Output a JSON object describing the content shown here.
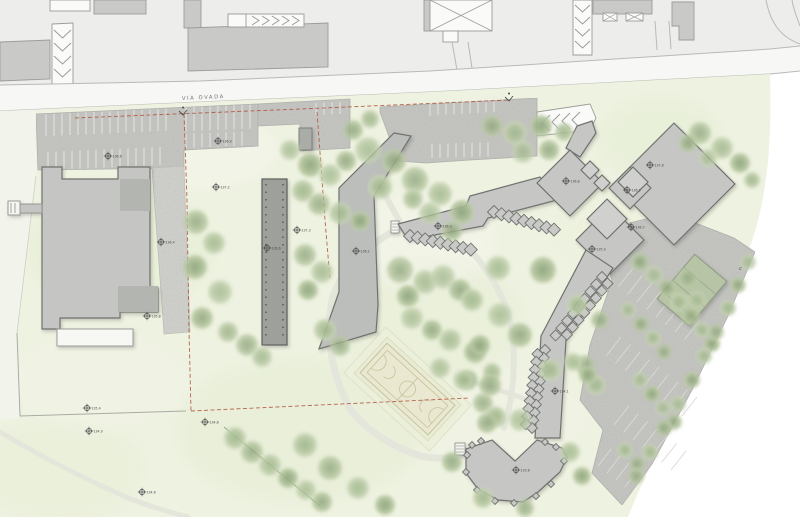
{
  "road": {
    "name": "VIA  OVADA",
    "curve_mark": "c"
  },
  "colors": {
    "field_green": "#eef2e0",
    "asphalt": "#c9c9c6",
    "building_gray": "#c6c7c5",
    "building_dark": "#9ea09c",
    "boundary_red": "#b2543e",
    "tree_green": "#a9bc98",
    "court_tan": "#eae8d0",
    "road_line": "#b9b9b6"
  },
  "symbols": {
    "benchmark": "circle-cross-elevation-marker",
    "entrance": "v-arrow-with-dot",
    "entrance_positions": [
      [
        183,
        112
      ],
      [
        509,
        98
      ]
    ],
    "curve_mark_position": [
      740,
      268
    ]
  },
  "elevation_markers": [
    {
      "x": 108,
      "y": 156,
      "v": "136.6"
    },
    {
      "x": 218,
      "y": 141,
      "v": "136.9"
    },
    {
      "x": 216,
      "y": 187,
      "v": "137.2"
    },
    {
      "x": 161,
      "y": 242,
      "v": "136.4"
    },
    {
      "x": 147,
      "y": 316,
      "v": "135.8"
    },
    {
      "x": 297,
      "y": 230,
      "v": "137.3"
    },
    {
      "x": 267,
      "y": 248,
      "v": "136.6"
    },
    {
      "x": 356,
      "y": 251,
      "v": "136.2"
    },
    {
      "x": 438,
      "y": 226,
      "v": "136.3"
    },
    {
      "x": 566,
      "y": 181,
      "v": "136.8"
    },
    {
      "x": 650,
      "y": 165,
      "v": "137.8"
    },
    {
      "x": 627,
      "y": 190,
      "v": "136.9"
    },
    {
      "x": 631,
      "y": 227,
      "v": "136.7"
    },
    {
      "x": 592,
      "y": 249,
      "v": "135.9"
    },
    {
      "x": 555,
      "y": 391,
      "v": "134.1"
    },
    {
      "x": 516,
      "y": 470,
      "v": "133.8"
    },
    {
      "x": 87,
      "y": 408,
      "v": "135.4"
    },
    {
      "x": 89,
      "y": 431,
      "v": "134.9"
    },
    {
      "x": 205,
      "y": 422,
      "v": "134.8"
    },
    {
      "x": 142,
      "y": 492,
      "v": "134.6"
    }
  ],
  "trees": [
    [
      368,
      150,
      13
    ],
    [
      394,
      161,
      12
    ],
    [
      380,
      187,
      12
    ],
    [
      415,
      180,
      13
    ],
    [
      440,
      194,
      12
    ],
    [
      462,
      212,
      12
    ],
    [
      430,
      213,
      11
    ],
    [
      452,
      231,
      10
    ],
    [
      413,
      199,
      10
    ],
    [
      492,
      126,
      11
    ],
    [
      515,
      133,
      12
    ],
    [
      541,
      126,
      11
    ],
    [
      523,
      152,
      11
    ],
    [
      549,
      150,
      10
    ],
    [
      564,
      132,
      9
    ],
    [
      700,
      133,
      11
    ],
    [
      722,
      148,
      11
    ],
    [
      740,
      163,
      10
    ],
    [
      708,
      158,
      9
    ],
    [
      688,
      143,
      9
    ],
    [
      752,
      180,
      8
    ],
    [
      196,
      222,
      12
    ],
    [
      214,
      243,
      11
    ],
    [
      195,
      267,
      12
    ],
    [
      220,
      292,
      12
    ],
    [
      202,
      318,
      11
    ],
    [
      228,
      332,
      10
    ],
    [
      247,
      345,
      11
    ],
    [
      262,
      357,
      10
    ],
    [
      310,
      165,
      12
    ],
    [
      330,
      175,
      11
    ],
    [
      346,
      161,
      10
    ],
    [
      303,
      191,
      11
    ],
    [
      319,
      204,
      11
    ],
    [
      340,
      213,
      11
    ],
    [
      360,
      221,
      10
    ],
    [
      290,
      150,
      10
    ],
    [
      353,
      130,
      10
    ],
    [
      370,
      119,
      9
    ],
    [
      400,
      270,
      13
    ],
    [
      425,
      282,
      12
    ],
    [
      408,
      296,
      11
    ],
    [
      443,
      277,
      12
    ],
    [
      460,
      290,
      11
    ],
    [
      472,
      300,
      11
    ],
    [
      305,
      255,
      11
    ],
    [
      322,
      272,
      11
    ],
    [
      308,
      290,
      10
    ],
    [
      412,
      318,
      11
    ],
    [
      432,
      330,
      10
    ],
    [
      325,
      330,
      11
    ],
    [
      340,
      346,
      10
    ],
    [
      498,
      268,
      12
    ],
    [
      543,
      270,
      13
    ],
    [
      500,
      315,
      12
    ],
    [
      520,
      335,
      12
    ],
    [
      577,
      305,
      10
    ],
    [
      600,
      320,
      9
    ],
    [
      450,
      340,
      11
    ],
    [
      475,
      352,
      11
    ],
    [
      440,
      368,
      10
    ],
    [
      468,
      380,
      10
    ],
    [
      492,
      372,
      9
    ],
    [
      483,
      403,
      10
    ],
    [
      497,
      418,
      9
    ],
    [
      480,
      345,
      10
    ],
    [
      463,
      380,
      10
    ],
    [
      490,
      385,
      11
    ],
    [
      235,
      438,
      11
    ],
    [
      252,
      452,
      11
    ],
    [
      270,
      465,
      11
    ],
    [
      288,
      478,
      10
    ],
    [
      306,
      490,
      10
    ],
    [
      322,
      502,
      10
    ],
    [
      305,
      445,
      12
    ],
    [
      330,
      468,
      12
    ],
    [
      358,
      488,
      11
    ],
    [
      385,
      505,
      10
    ],
    [
      495,
      416,
      10
    ],
    [
      452,
      462,
      10
    ],
    [
      483,
      498,
      10
    ],
    [
      525,
      508,
      9
    ],
    [
      570,
      452,
      10
    ],
    [
      582,
      476,
      9
    ],
    [
      520,
      420,
      11
    ],
    [
      487,
      423,
      10
    ],
    [
      550,
      370,
      11
    ],
    [
      585,
      365,
      10
    ],
    [
      596,
      385,
      10
    ],
    [
      640,
      262,
      9
    ],
    [
      654,
      275,
      9
    ],
    [
      667,
      288,
      9
    ],
    [
      679,
      302,
      9
    ],
    [
      691,
      316,
      9
    ],
    [
      702,
      330,
      8
    ],
    [
      712,
      344,
      8
    ],
    [
      628,
      310,
      8
    ],
    [
      641,
      324,
      8
    ],
    [
      653,
      338,
      8
    ],
    [
      664,
      352,
      8
    ],
    [
      640,
      380,
      8
    ],
    [
      652,
      394,
      8
    ],
    [
      663,
      408,
      8
    ],
    [
      674,
      422,
      8
    ],
    [
      625,
      450,
      8
    ],
    [
      637,
      464,
      8
    ],
    [
      573,
      362,
      9
    ],
    [
      588,
      375,
      9
    ],
    [
      748,
      262,
      8
    ],
    [
      738,
      285,
      8
    ],
    [
      728,
      308,
      8
    ],
    [
      716,
      332,
      8
    ],
    [
      704,
      356,
      8
    ],
    [
      692,
      380,
      8
    ],
    [
      678,
      404,
      8
    ],
    [
      664,
      428,
      8
    ],
    [
      650,
      452,
      8
    ],
    [
      636,
      476,
      8
    ]
  ]
}
